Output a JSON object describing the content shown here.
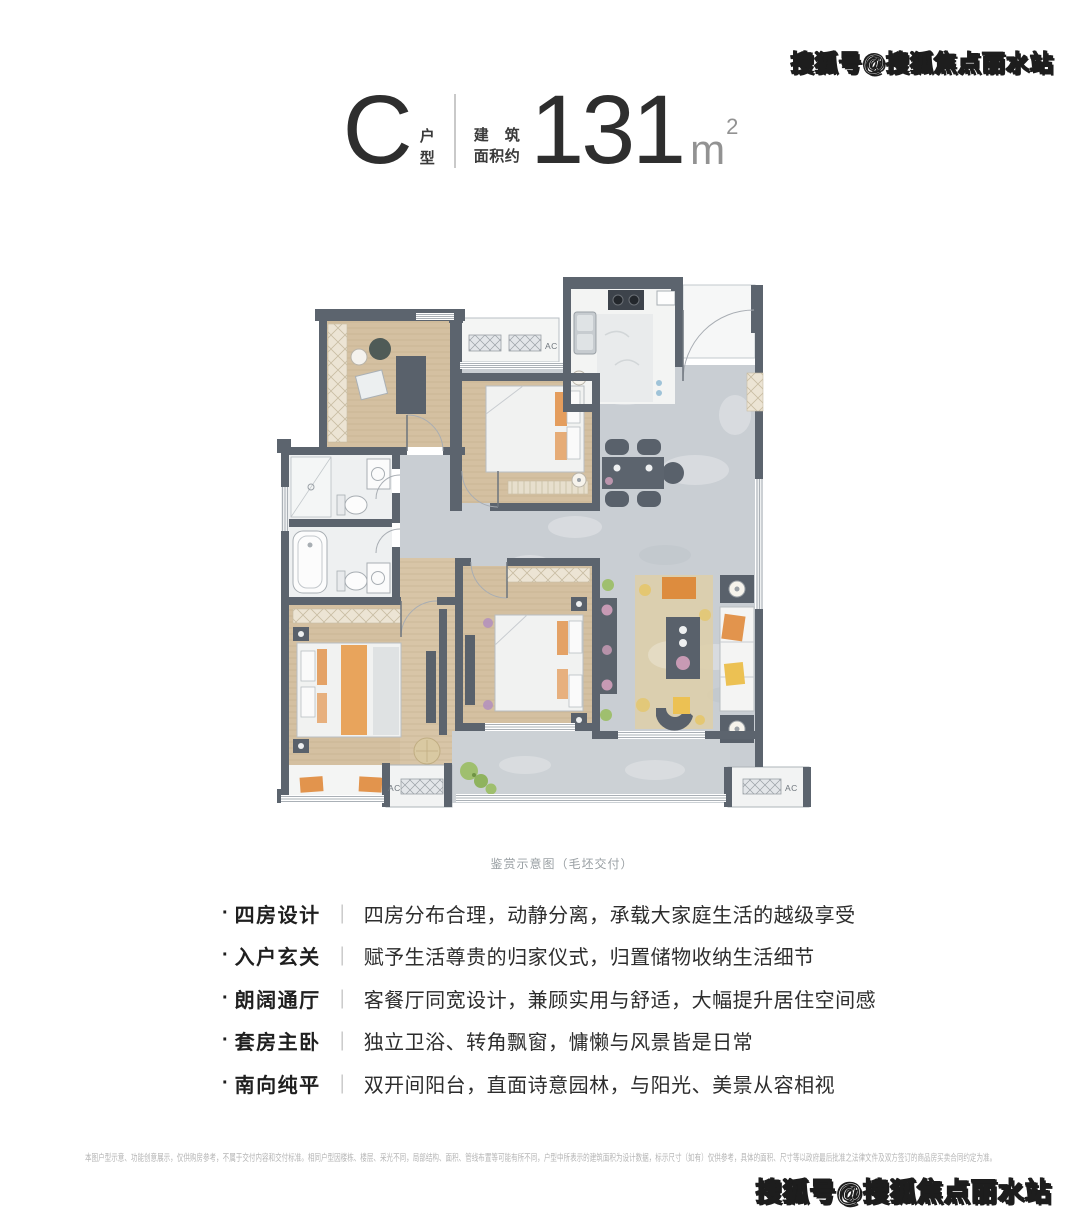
{
  "header": {
    "type_letter": "C",
    "type_label_top": "户",
    "type_label_bottom": "型",
    "area_prefix_line1": "建　筑",
    "area_prefix_line2": "面积约",
    "area_value": "131",
    "area_unit_base": "m",
    "area_unit_sup": "2"
  },
  "floorplan": {
    "caption": "鉴赏示意图（毛坯交付）",
    "ac_labels": [
      "AC",
      "AC",
      "AC"
    ]
  },
  "features": {
    "bullet": "·",
    "separator": "｜",
    "items": [
      {
        "label": "四房设计",
        "text": "四房分布合理，动静分离，承载大家庭生活的越级享受"
      },
      {
        "label": "入户玄关",
        "text": "赋予生活尊贵的归家仪式，归置储物收纳生活细节"
      },
      {
        "label": "朗阔通厅",
        "text": "客餐厅同宽设计，兼顾实用与舒适，大幅提升居住空间感"
      },
      {
        "label": "套房主卧",
        "text": "独立卫浴、转角飘窗，慵懒与风景皆是日常"
      },
      {
        "label": "南向纯平",
        "text": "双开间阳台，直面诗意园林，与阳光、美景从容相视"
      }
    ]
  },
  "disclaimer": "本图户型示意、功能创意展示，仅供购房参考，不属于交付内容和交付标准。相同户型因楼栋、楼层、采光不同，局部结构、面积、管线布置等可能有所不同，户型中所表示的建筑面积为设计数据，标示尺寸（如有）仅供参考，具体的面积、尺寸等以政府最后批准之法律文件及双方签订的商品房买卖合同约定为准。",
  "watermarks": {
    "top_right": "搜狐号@搜狐焦点丽水站",
    "bottom_right": "搜狐号@搜狐焦点丽水站"
  },
  "colors": {
    "wall": "#5c646e",
    "wood": "#d4c0a1",
    "stone": "#c9ced3",
    "accent_orange": "#e2944d",
    "accent_yellow": "#ecc153",
    "text_dark": "#2b2b2b",
    "text_gray": "#9aa0a4"
  }
}
